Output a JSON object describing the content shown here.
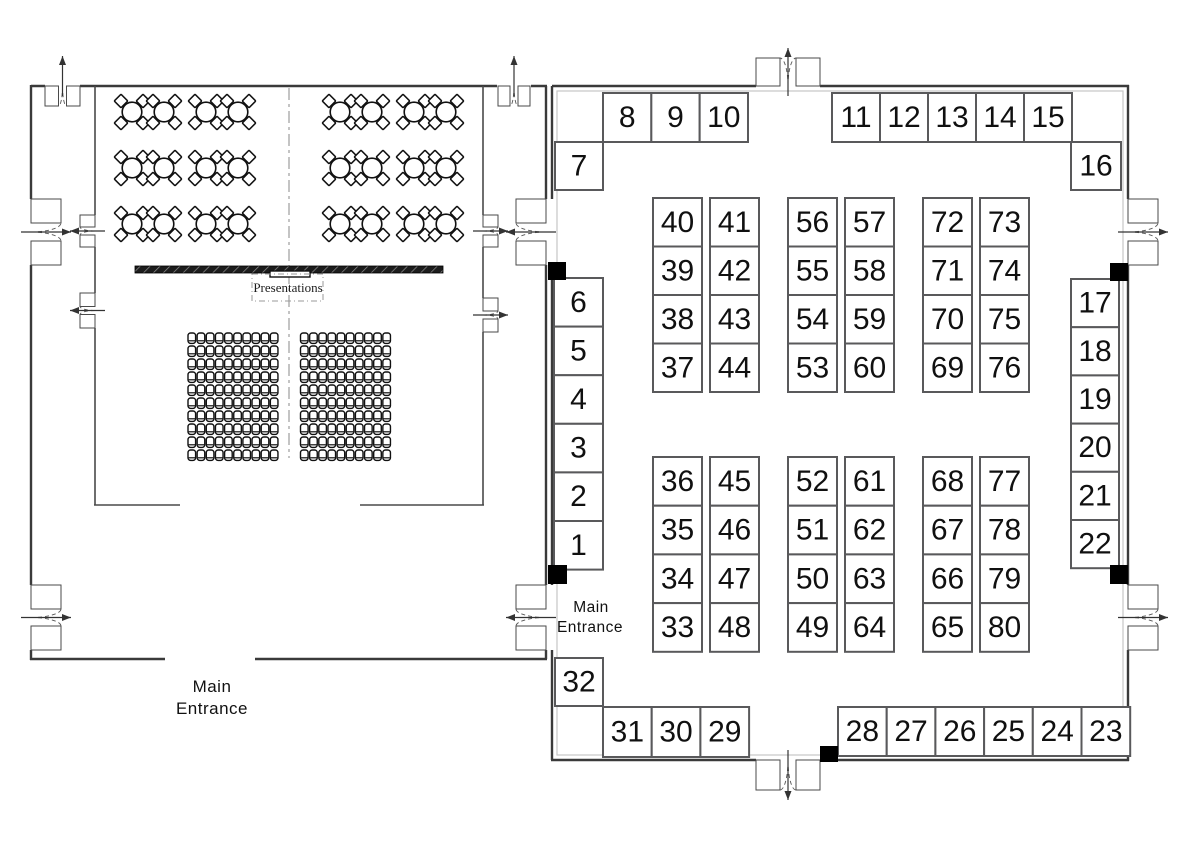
{
  "colors": {
    "wall": "#3a3a3a",
    "inner_wall": "#4a4a4a",
    "booth_border": "#59595b",
    "booth_text": "#101010",
    "marker_black": "#000000",
    "door_arc": "#555555"
  },
  "left_room": {
    "stage_label": "Presentations",
    "entrance_label_line1": "Main",
    "entrance_label_line2": "Entrance"
  },
  "right_room": {
    "entrance_label_line1": "Main",
    "entrance_label_line2": "Entrance"
  },
  "booths": {
    "top_row_left": [
      "8",
      "9",
      "10"
    ],
    "top_row_right": [
      "11",
      "12",
      "13",
      "14",
      "15"
    ],
    "left_of_top_row": "7",
    "right_of_top_row": "16",
    "left_column": [
      "6",
      "5",
      "4",
      "3",
      "2",
      "1"
    ],
    "right_column": [
      "17",
      "18",
      "19",
      "20",
      "21",
      "22"
    ],
    "upper_grid_columns": [
      [
        "40",
        "39",
        "38",
        "37"
      ],
      [
        "41",
        "42",
        "43",
        "44"
      ],
      [
        "56",
        "55",
        "54",
        "53"
      ],
      [
        "57",
        "58",
        "59",
        "60"
      ],
      [
        "72",
        "71",
        "70",
        "69"
      ],
      [
        "73",
        "74",
        "75",
        "76"
      ]
    ],
    "lower_grid_columns": [
      [
        "36",
        "35",
        "34",
        "33"
      ],
      [
        "45",
        "46",
        "47",
        "48"
      ],
      [
        "52",
        "51",
        "50",
        "49"
      ],
      [
        "61",
        "62",
        "63",
        "64"
      ],
      [
        "68",
        "67",
        "66",
        "65"
      ],
      [
        "77",
        "78",
        "79",
        "80"
      ]
    ],
    "booth_32": "32",
    "bottom_row_left": [
      "31",
      "30",
      "29"
    ],
    "bottom_row_right": [
      "28",
      "27",
      "26",
      "25",
      "24",
      "23"
    ]
  }
}
